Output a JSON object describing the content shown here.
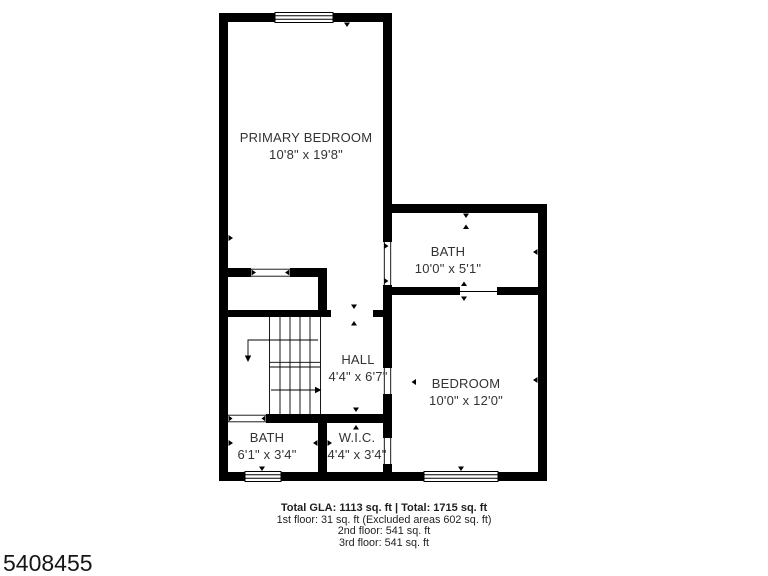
{
  "floorplan": {
    "rooms": [
      {
        "id": "primary-bedroom",
        "name": "PRIMARY BEDROOM",
        "dims": "10'8\" x 19'8\""
      },
      {
        "id": "bath-upper",
        "name": "BATH",
        "dims": "10'0\" x 5'1\""
      },
      {
        "id": "hall",
        "name": "HALL",
        "dims": "4'4\" x 6'7\""
      },
      {
        "id": "bedroom",
        "name": "BEDROOM",
        "dims": "10'0\" x 12'0\""
      },
      {
        "id": "bath-lower",
        "name": "BATH",
        "dims": "6'1\" x 3'4\""
      },
      {
        "id": "wic",
        "name": "W.I.C.",
        "dims": "4'4\" x 3'4\""
      }
    ],
    "summary": {
      "total_line": "Total GLA: 1113 sq. ft | Total: 1715 sq. ft",
      "floor_lines": [
        "1st floor: 31 sq. ft (Excluded areas 602 sq. ft)",
        "2nd floor: 541 sq. ft",
        "3rd floor: 541 sq. ft"
      ]
    },
    "photo_id": "5408455",
    "colors": {
      "wall": "#000000",
      "text": "#333333",
      "background": "#ffffff"
    }
  }
}
